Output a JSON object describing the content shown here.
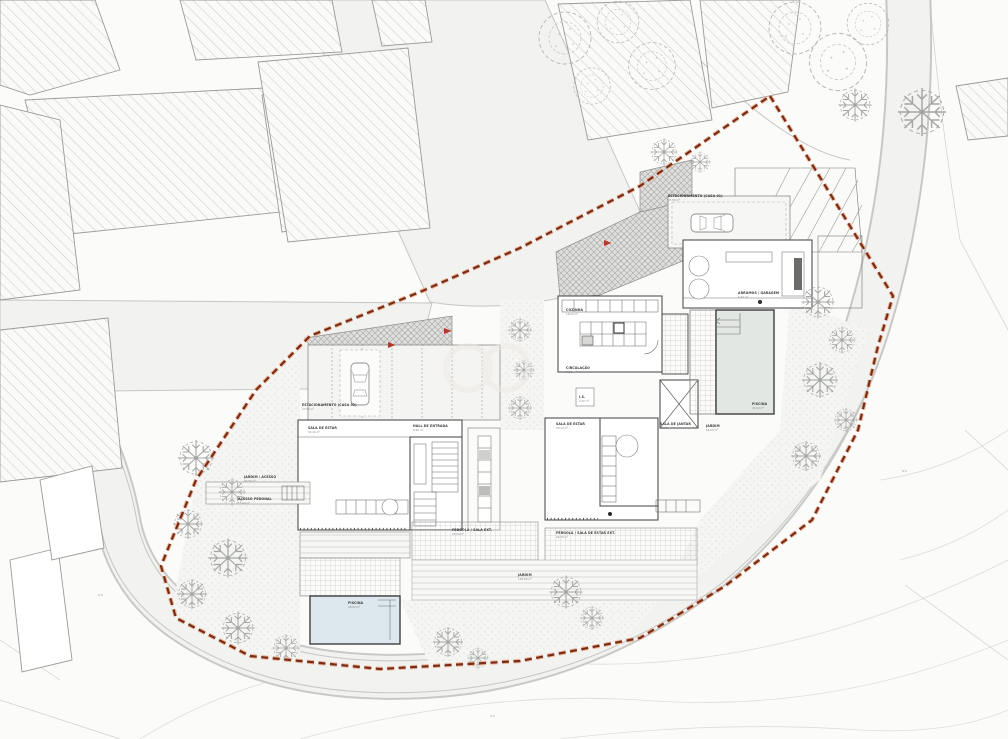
{
  "drawing": {
    "kind": "architectural site plan / implantation plan",
    "colors": {
      "boundary": "#7a2c1a",
      "boundary_halo": "#e8b493",
      "pool_left": "#dce8ee",
      "pool_right": "#e2e7e3",
      "arrow_red": "#b5392b",
      "paper": "#fbfbfa",
      "road": "#f2f2f0",
      "hatch_gray": "#b9b9b9",
      "tree_gray": "#a3a6a4"
    }
  },
  "labels": {
    "est1": {
      "name": "ESTACIONAMENTO (CASA 01)",
      "area": "27.50 m²"
    },
    "est2": {
      "name": "ESTACIONAMENTO (CASA 02)",
      "area": "27.50 m²"
    },
    "cozinha": {
      "name": "COZINHA",
      "area": "18.20 m²"
    },
    "circulacao": {
      "name": "CIRCULAÇÃO",
      "area": "9.80 m²"
    },
    "sala_estar_1": {
      "name": "SALA DE ESTAR",
      "area": "32.40 m²"
    },
    "hall": {
      "name": "HALL DE ENTRADA",
      "area": "8.60 m²"
    },
    "sala_estar_2": {
      "name": "SALA DE ESTAR",
      "area": "30.10 m²"
    },
    "sala_jantar": {
      "name": "SALA DE JANTAR",
      "area": "16.90 m²"
    },
    "jardim_right": {
      "name": "JARDIM",
      "area": "64.00 m²"
    },
    "piscina_1": {
      "name": "PISCINA",
      "area": "32.00 m²"
    },
    "piscina_2": {
      "name": "PISCINA",
      "area": "28.00 m²"
    },
    "pergola_1": {
      "name": "PÉRGOLA / SALA EXT.",
      "area": "24.00 m²"
    },
    "pergola_2": {
      "name": "PÉRGOLA / SALA DE ESTAR EXT.",
      "area": "26.30 m²"
    },
    "jardim_sul": {
      "name": "JARDIM",
      "area": "118.00 m²"
    },
    "jardim_oeste": {
      "name": "JARDIM / ACESSO",
      "area": "96.50 m²"
    },
    "acesso": {
      "name": "ACESSO PEDONAL",
      "area": "15.60 m²"
    },
    "arrumos": {
      "name": "ARRUMOS / GARAGEM",
      "area": "6.40 m²"
    },
    "is1": {
      "name": "I.S.",
      "area": "3.20 m²"
    }
  },
  "elevations": [
    "9.5",
    "9.0",
    "8.5"
  ]
}
